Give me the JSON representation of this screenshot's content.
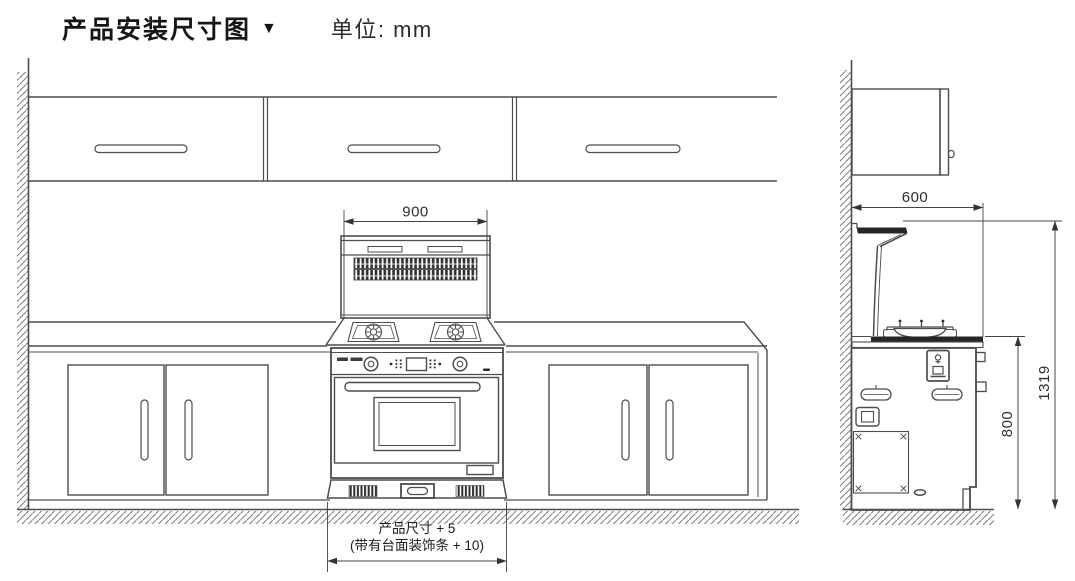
{
  "header": {
    "title": "产品安装尺寸图",
    "marker": "▼",
    "unit": "单位: mm"
  },
  "dimensions": {
    "hood_width": "900",
    "depth": "600",
    "worktop_height": "800",
    "total_height": "1319"
  },
  "notes": {
    "product_size_line1": "产品尺寸 + 5",
    "product_size_line2": "(带有台面装饰条 + 10)"
  },
  "colors": {
    "line": "#4d4d4d",
    "dark_fill": "#262626",
    "text": "#2e2e2e",
    "background": "#ffffff"
  }
}
